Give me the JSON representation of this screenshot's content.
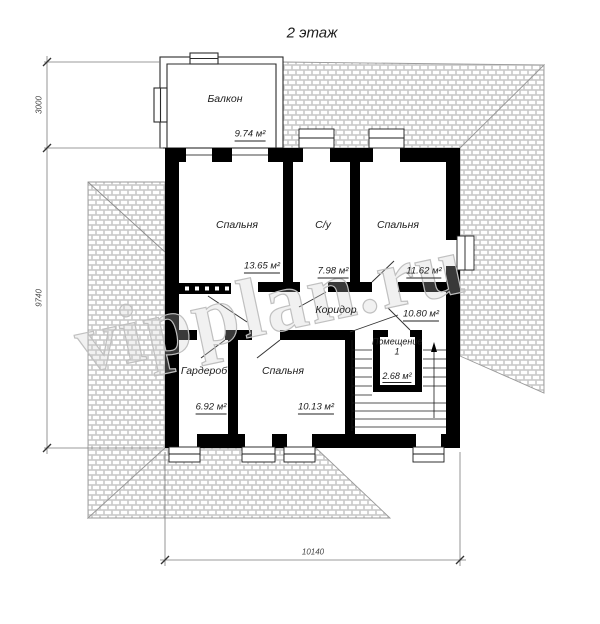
{
  "title": "2 этаж",
  "watermark": "vipplan.ru",
  "rooms": {
    "balcony": {
      "name": "Балкон",
      "area": "9.74 м²"
    },
    "bedroom1": {
      "name": "Спальня",
      "area": "13.65 м²"
    },
    "bathroom": {
      "name": "С/у",
      "area": "7.98 м²"
    },
    "bedroom2": {
      "name": "Спальня",
      "area": "11.62 м²"
    },
    "corridor": {
      "name": "Коридор",
      "area": "10.80 м²"
    },
    "wardrobe": {
      "name": "Гардероб",
      "area": "6.92 м²"
    },
    "bedroom3": {
      "name": "Спальня",
      "area": "10.13 м²"
    },
    "room1": {
      "name": "Помещение 1",
      "area": "2.68 м²"
    }
  },
  "dimensions": {
    "balcony_depth": "3000",
    "building_depth": "9740",
    "building_width": "10140"
  },
  "colors": {
    "wall": "#000000",
    "roof_line": "#9a9a9a",
    "dimension_line": "#777777",
    "text": "#1c1c1c",
    "watermark": "#c0c0c0"
  }
}
